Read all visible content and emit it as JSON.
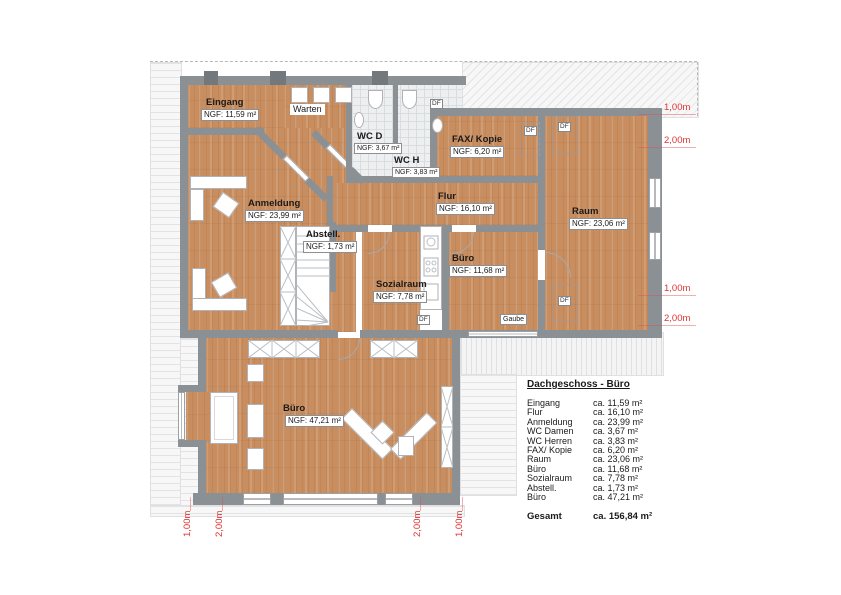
{
  "plan": {
    "rooms": [
      {
        "name": "Eingang",
        "ngf": "NGF: 11,59 m²"
      },
      {
        "name": "Warten",
        "ngf": ""
      },
      {
        "name": "WC D",
        "ngf": "NGF: 3,67 m²"
      },
      {
        "name": "WC H",
        "ngf": "NGF: 3,83 m²"
      },
      {
        "name": "FAX/ Kopie",
        "ngf": "NGF: 6,20 m²"
      },
      {
        "name": "Flur",
        "ngf": "NGF: 16,10 m²"
      },
      {
        "name": "Raum",
        "ngf": "NGF: 23,06 m²"
      },
      {
        "name": "Anmeldung",
        "ngf": "NGF: 23,99 m²"
      },
      {
        "name": "Abstell.",
        "ngf": "NGF: 1,73 m²"
      },
      {
        "name": "Sozialraum",
        "ngf": "NGF: 7,78 m²"
      },
      {
        "name": "Büro",
        "ngf": "NGF: 11,68 m²"
      },
      {
        "name": "Büro",
        "ngf": "NGF: 47,21 m²"
      }
    ],
    "markers": {
      "df": "DF",
      "gaube": "Gaube"
    },
    "dims_right": [
      "1,00m",
      "2,00m",
      "1,00m",
      "2,00m"
    ],
    "dims_bottom": [
      "1,00m",
      "2,00m",
      "2,00m",
      "1,00m"
    ]
  },
  "legend": {
    "title": "Dachgeschoss - Büro",
    "rows": [
      {
        "name": "Eingang",
        "area": "ca. 11,59 m²"
      },
      {
        "name": "Flur",
        "area": "ca. 16,10 m²"
      },
      {
        "name": "Anmeldung",
        "area": "ca. 23,99 m²"
      },
      {
        "name": "WC Damen",
        "area": "ca. 3,67 m²"
      },
      {
        "name": "WC Herren",
        "area": "ca. 3,83 m²"
      },
      {
        "name": "FAX/ Kopie",
        "area": "ca. 6,20 m²"
      },
      {
        "name": "Raum",
        "area": "ca. 23,06 m²"
      },
      {
        "name": "Büro",
        "area": "ca. 11,68 m²"
      },
      {
        "name": "Sozialraum",
        "area": "ca. 7,78 m²"
      },
      {
        "name": "Abstell.",
        "area": "ca. 1,73 m²"
      },
      {
        "name": "Büro",
        "area": "ca. 47,21 m²"
      }
    ],
    "total_label": "Gesamt",
    "total_value": "ca. 156,84 m²"
  },
  "colors": {
    "wood": "#c98e60",
    "wall_gray": "#8b9094",
    "tile": "#edeff0",
    "dimension_red": "#dd3434"
  }
}
